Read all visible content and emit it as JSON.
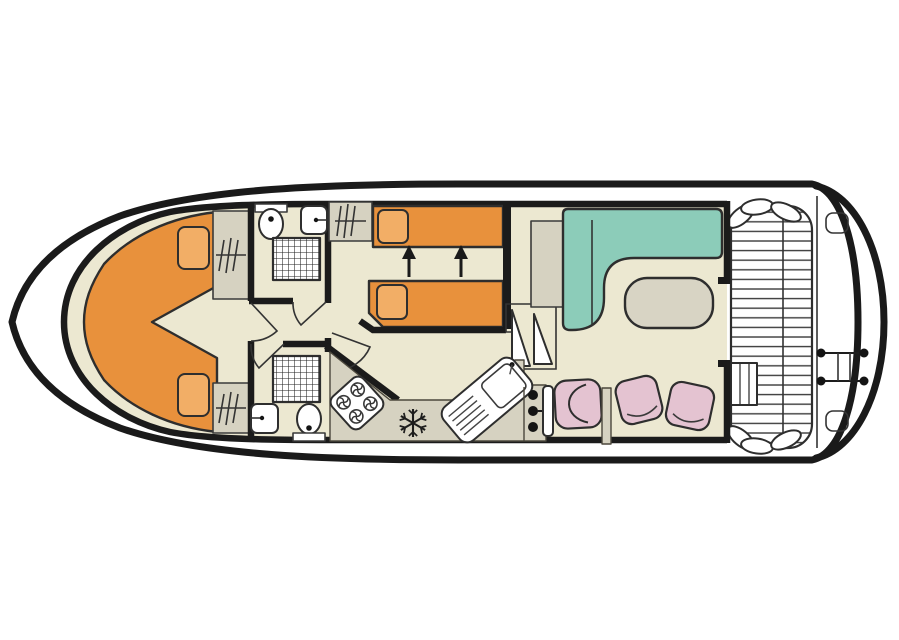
{
  "meta": {
    "diagram_type": "boat-floor-plan",
    "subject": "Top-down deck plan of a canal cruiser houseboat, bow at left, stern deck at right",
    "text_labels": []
  },
  "colors": {
    "hull_white": "#ffffff",
    "outline_dark": "#1a1a1a",
    "floor_beige": "#ece8d1",
    "furniture_orange": "#e8913c",
    "pillow_orange": "#f2ae66",
    "cabinet_grey": "#d6d2c1",
    "sofa_teal": "#8cccb9",
    "chair_pink": "#e4c3d1",
    "table_grey": "#d8d4c4",
    "fixture_white": "#ffffff",
    "deck_white": "#ffffff"
  },
  "rooms": [
    {
      "id": "bow-cabin",
      "label": "V-berth bow cabin with double bed and two wardrobes"
    },
    {
      "id": "bathroom-forward",
      "label": "Forward bathroom: toilet, washbasin, shower"
    },
    {
      "id": "bathroom-aft",
      "label": "Aft bathroom: toilet, washbasin, shower"
    },
    {
      "id": "twin-cabin",
      "label": "Twin cabin, beds slide together (arrows)"
    },
    {
      "id": "galley",
      "label": "Galley: 4-ring hob, fridge-freezer, sink with drainboard"
    },
    {
      "id": "saloon",
      "label": "Saloon: L-shaped sofa, table, helm console, seats"
    },
    {
      "id": "aft-deck",
      "label": "Slatted aft deck: perimeter bench, corner cushions, steps, swim ladder"
    }
  ],
  "icons": {
    "snowflake-icon": "fridge-freezer",
    "hanger-rail-icon": "wardrobe clothes rail",
    "shower-grid-icon": "shower tray",
    "burner-icon": "hob ring",
    "arrow-up-icon": "bed conversion direction",
    "swim-ladder-icon": "stern bathing ladder",
    "door-swing-icon": "door with swing arc"
  }
}
